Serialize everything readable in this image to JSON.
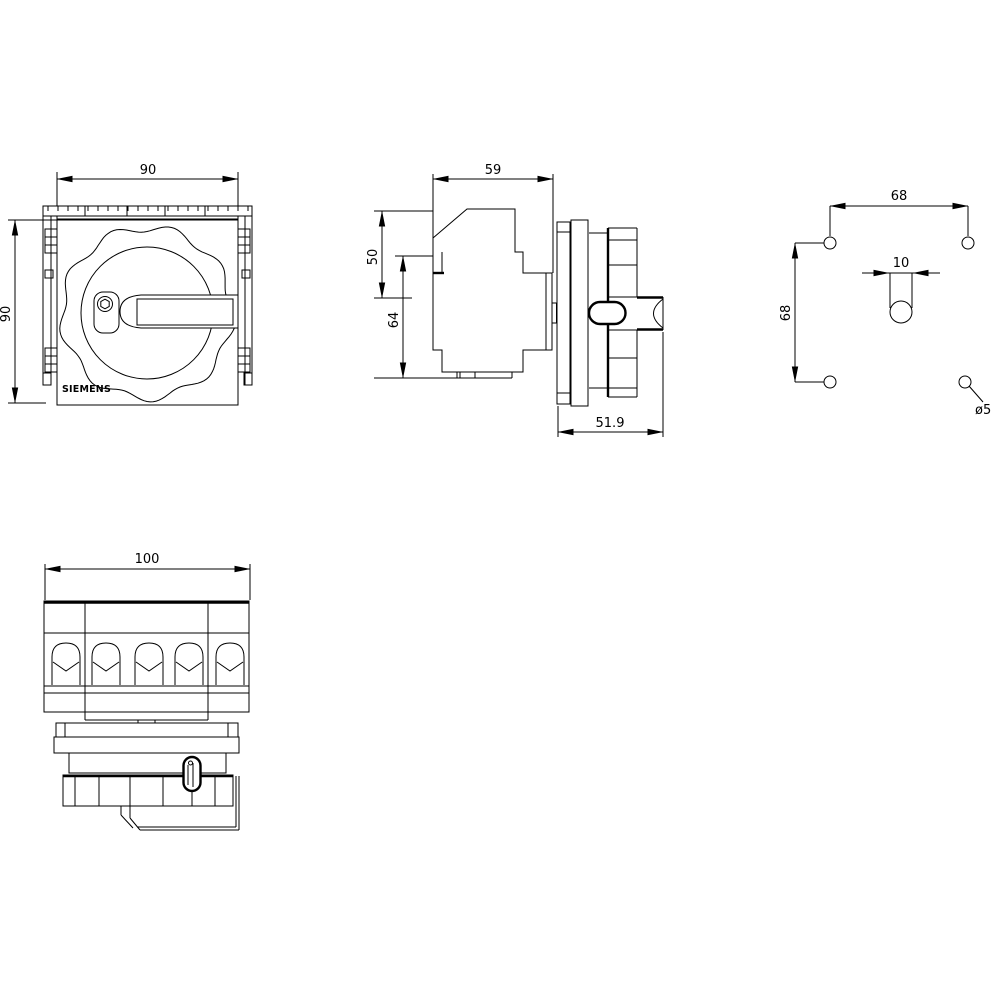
{
  "drawing": {
    "brand_label": "SIEMENS",
    "front_view": {
      "width_mm": "90",
      "height_mm": "90"
    },
    "side_view": {
      "depth_mm": "59",
      "upper_section_mm": "50",
      "body_height_mm": "64",
      "operator_depth_mm": "51.9"
    },
    "drilling_plan": {
      "hole_spacing_h_mm": "68",
      "hole_spacing_v_mm": "68",
      "shaft_slot_width_mm": "10",
      "hole_diameter_label": "ø5"
    },
    "top_view": {
      "width_mm": "100"
    }
  }
}
